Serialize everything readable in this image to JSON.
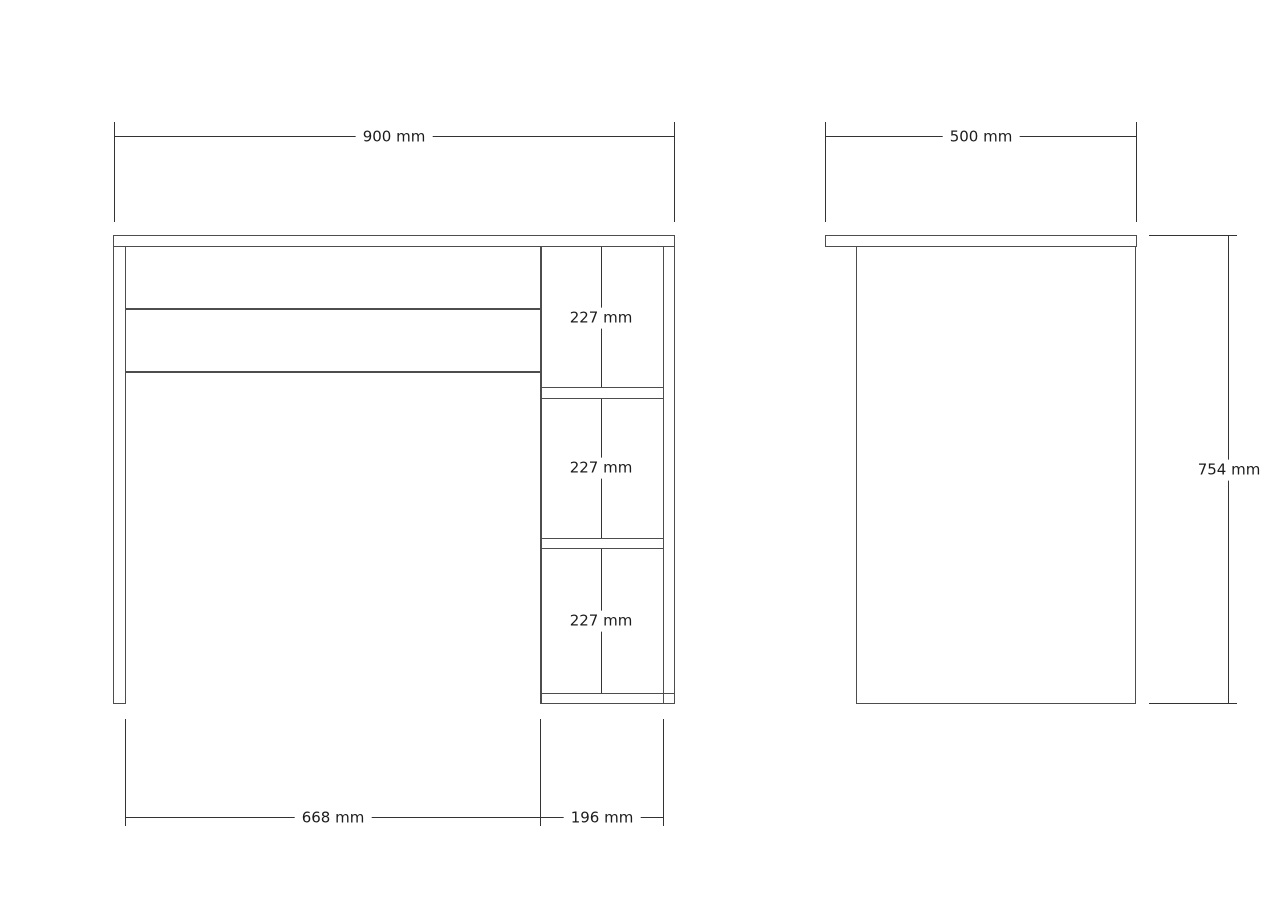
{
  "colors": {
    "background": "#ffffff",
    "outline": "#4d4d4d",
    "dimension": "#333333",
    "text": "#1c1c1c"
  },
  "front_view": {
    "overall_width_label": "900 mm",
    "shelf_opening_labels": [
      "227 mm",
      "227 mm",
      "227 mm"
    ],
    "open_bay_width_label": "668 mm",
    "shelf_bay_width_label": "196 mm"
  },
  "side_view": {
    "depth_label": "500 mm",
    "height_label": "754 mm"
  }
}
